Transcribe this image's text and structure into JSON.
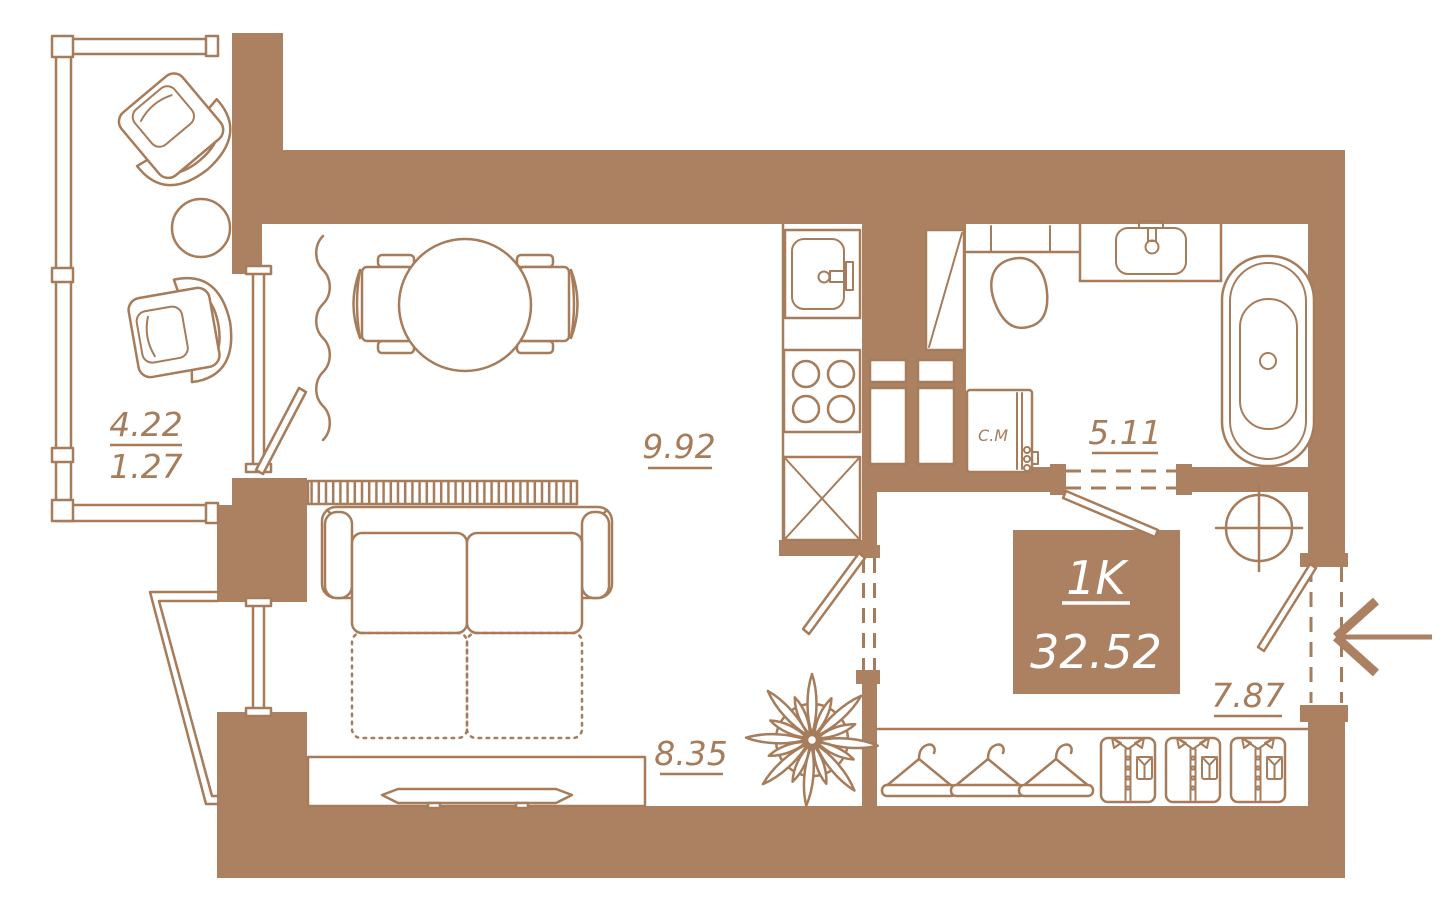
{
  "plan": {
    "unit": {
      "type": "1K",
      "total_area": "32.52"
    },
    "rooms": {
      "balcony": {
        "area": "4.22",
        "area_coeff": "1.27"
      },
      "kitchen_living": {
        "area": "9.92"
      },
      "living_zone": {
        "area": "8.35"
      },
      "bathroom": {
        "area": "5.11"
      },
      "hallway": {
        "area": "7.87"
      }
    },
    "labels": {
      "washing_machine": "С.М"
    },
    "colors": {
      "wall": "#AB8162",
      "line": "#A67C5B",
      "text_on_wall": "#FFFFFF"
    }
  }
}
